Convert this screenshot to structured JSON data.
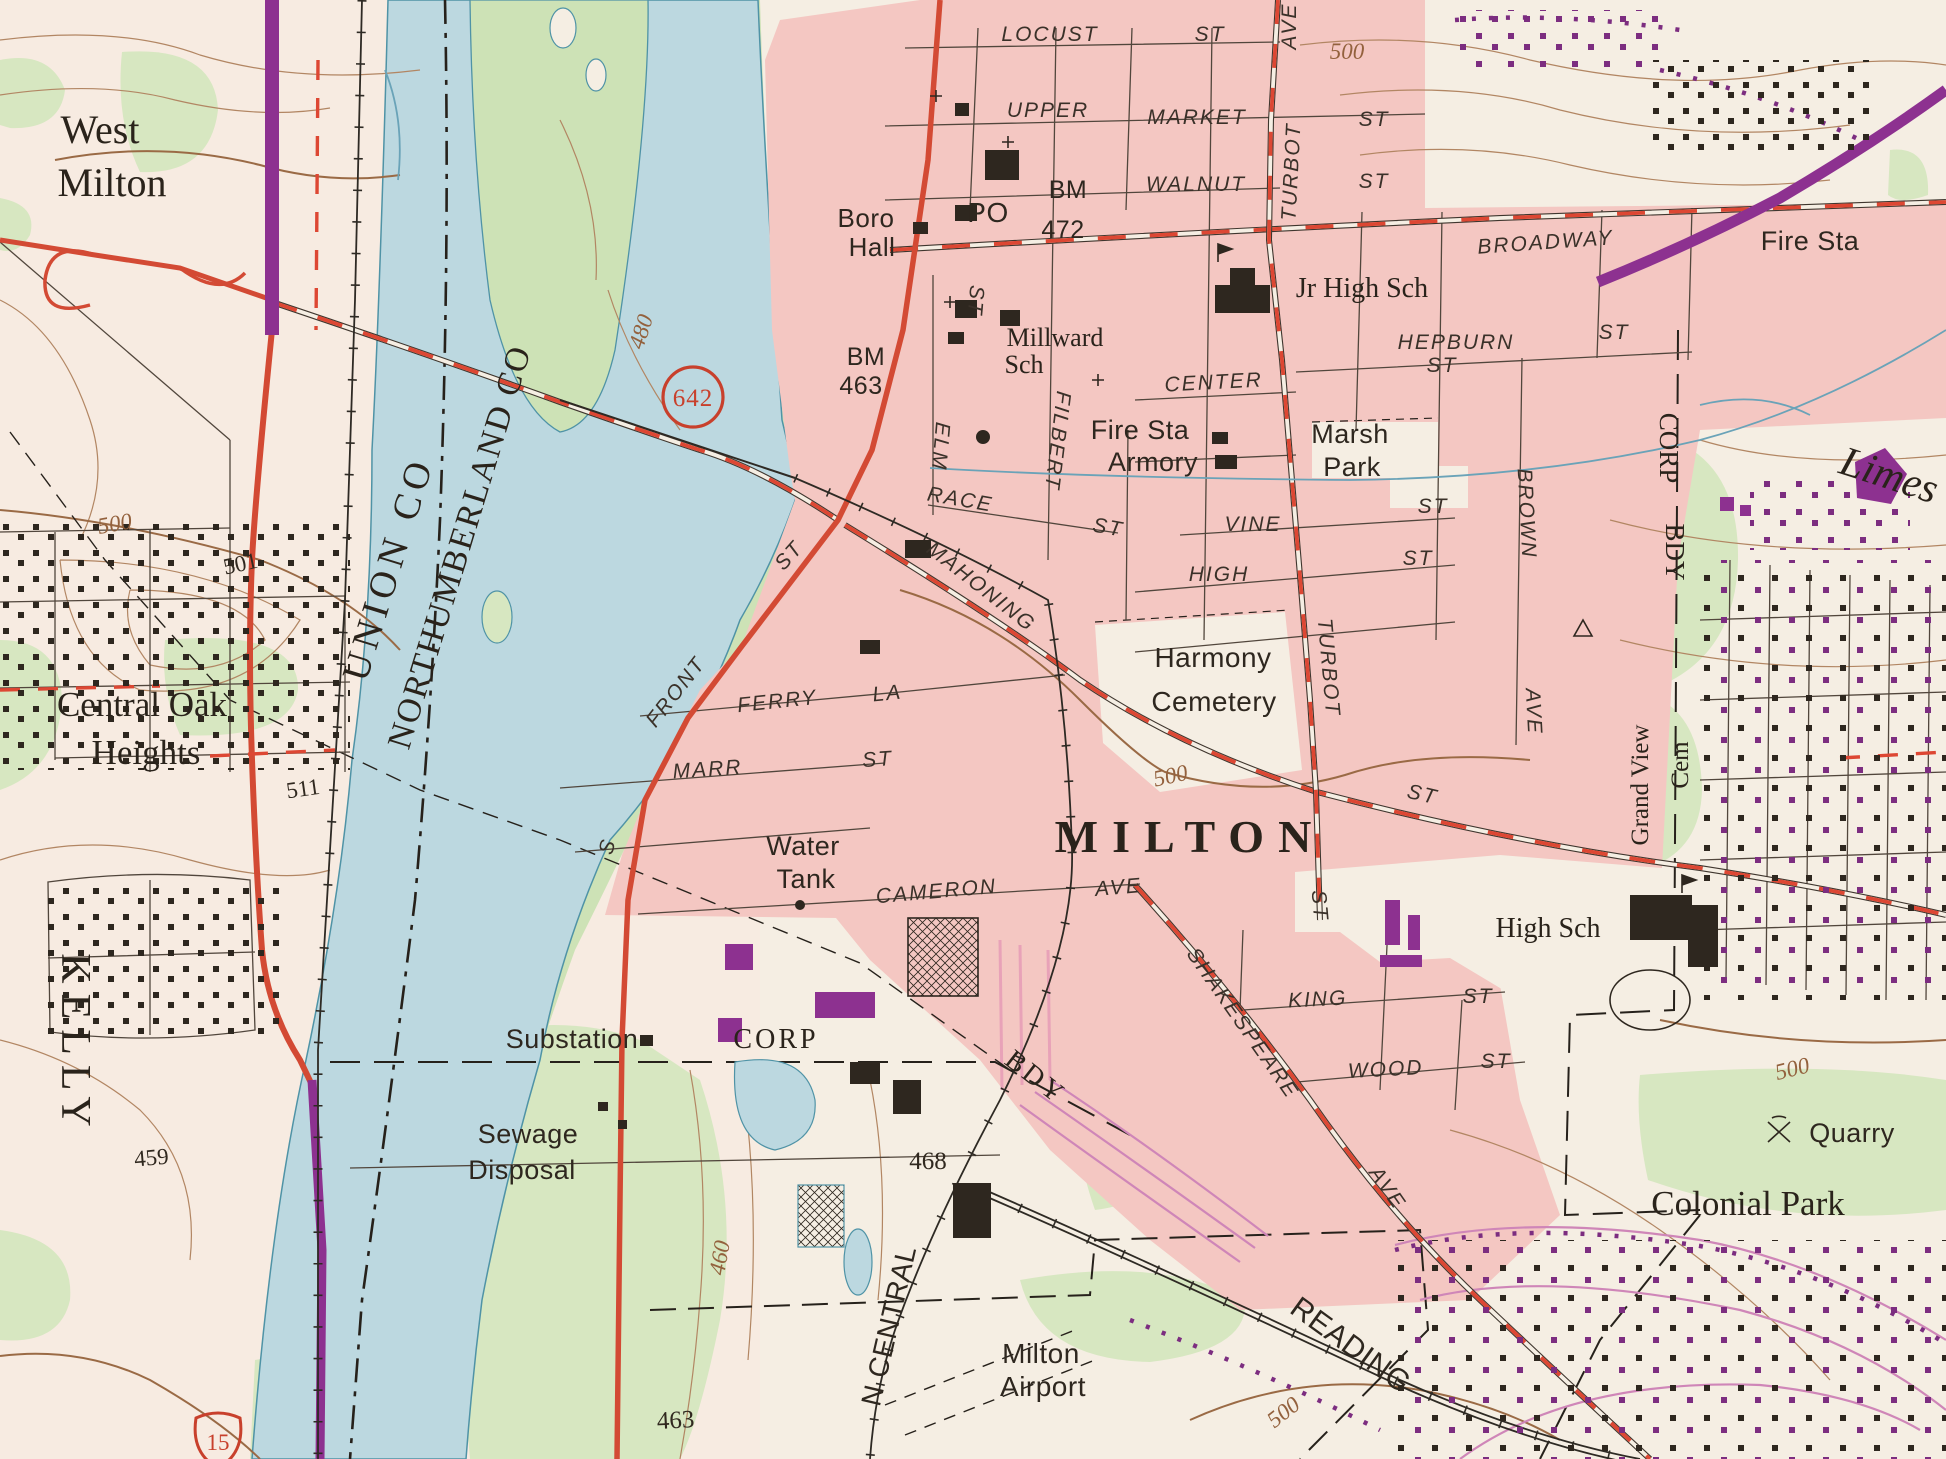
{
  "title": "Milton PA topographic map excerpt",
  "colors": {
    "paper": "#f5eee3",
    "urban_pink": "#f4c7c2",
    "water": "#bcd8e0",
    "water_edge": "#4f93a6",
    "vegetation": "#d7e7c1",
    "vegetation_dark": "#cde2b6",
    "road_red": "#d34a34",
    "road_dash_red": "#dd4733",
    "highway_purple": "#8d3190",
    "contour_brown": "#b28663",
    "contour_label_brown": "#93613d",
    "ink": "#2e271f",
    "street_grid": "#51463c",
    "stream_blue": "#6aa3b8",
    "pink_road": "#cf86b8"
  },
  "shields": {
    "route_642": "642",
    "route_15": "15"
  },
  "labels": {
    "west": "West",
    "west_milton": "Milton",
    "central_oak": "Central Oak",
    "heights": "Heights",
    "kelly": "KELLY",
    "union_co": "UNION CO",
    "northumberland_co": "NORTHUMBERLAND CO",
    "milton": "MILTON",
    "jr_high_sch": "Jr High Sch",
    "high_sch": "High Sch",
    "millward": "Millward",
    "millward_sch": "Sch",
    "colonial_park": "Colonial Park",
    "grand_view": "Grand View",
    "grand_view_cem": "Cem",
    "limestone": "Limes",
    "corp_e1": "CORP",
    "corp_e2": "BDY",
    "corp_w": "CORP",
    "bdy_w": "BDY",
    "reading_rr": "READING",
    "penn_central_rr": "N CENTRAL",
    "boro": "Boro",
    "hall": "Hall",
    "po": "PO",
    "bm1": "BM",
    "bm1_val": "472",
    "bm2": "BM",
    "bm2_val": "463",
    "fire_sta_ne": "Fire Sta",
    "fire_sta": "Fire Sta",
    "armory": "Armory",
    "marsh": "Marsh",
    "marsh_park": "Park",
    "harmony": "Harmony",
    "harmony_cemetery": "Cemetery",
    "water_tank1": "Water",
    "water_tank2": "Tank",
    "substation": "Substation",
    "sewage": "Sewage",
    "disposal": "Disposal",
    "milton_airport1": "Milton",
    "milton_airport2": "Airport",
    "quarry": "Quarry",
    "locust": "LOCUST",
    "locust_st": "ST",
    "upper": "UPPER",
    "market": "MARKET",
    "market_st": "ST",
    "walnut": "WALNUT",
    "walnut_st": "ST",
    "turbot_ave_ave": "AVE",
    "turbot_ave": "TURBOT",
    "broadway": "BROADWAY",
    "hepburn": "HEPBURN",
    "hepburn_st": "ST",
    "hepburn_st_e": "ST",
    "center": "CENTER",
    "elm": "ELM",
    "elm_st": "ST",
    "filbert": "FILBERT",
    "race": "RACE",
    "race_st": "ST",
    "vine": "VINE",
    "vine_st": "ST",
    "high": "HIGH",
    "high_st": "ST",
    "mahoning": "MAHONING",
    "mahoning_st_e": "ST",
    "front": "FRONT",
    "front_st": "ST",
    "front_s": "S",
    "ferry": "FERRY",
    "ferry_la": "LA",
    "marr": "MARR",
    "marr_st": "ST",
    "cameron": "CAMERON",
    "cameron_ave": "AVE",
    "shakespeare": "SHAKESPEARE",
    "shakespeare_ave": "AVE",
    "king": "KING",
    "king_st": "ST",
    "wood": "WOOD",
    "wood_st": "ST",
    "turbot_s": "TURBOT",
    "turbot_s_st": "ST",
    "brown": "BROWN",
    "brown_ave": "AVE",
    "c500_ne": "500",
    "c480": "480",
    "c500_w": "500",
    "c500_cem": "500",
    "c460": "460",
    "c500_se": "500",
    "c500_s": "500",
    "e501": "501",
    "e511": "511",
    "e459": "459",
    "e463": "463",
    "e468": "468"
  }
}
